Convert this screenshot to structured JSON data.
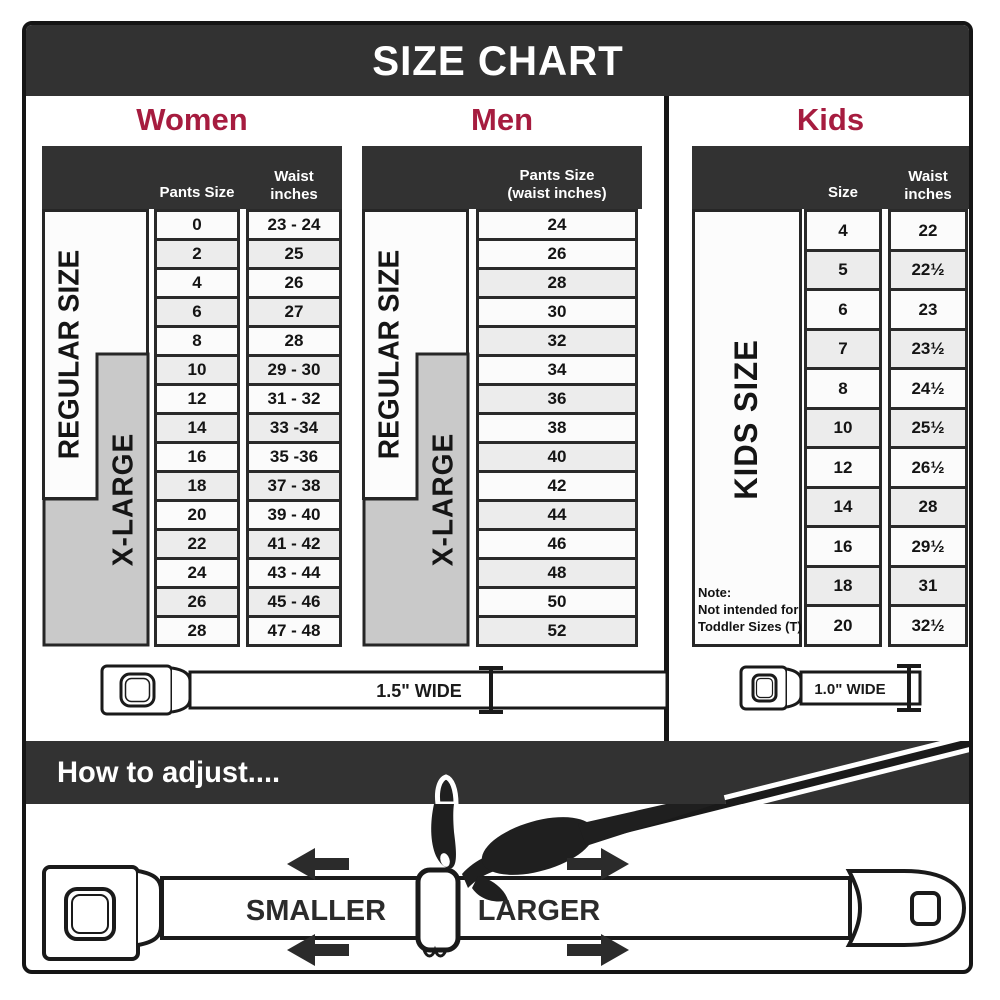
{
  "title": "SIZE CHART",
  "colors": {
    "accent_red": "#A61C3F",
    "header_bar": "#323232",
    "row_alt": "#ECECEC",
    "row_white": "#FBFBFB",
    "label_gray": "#C9C9C9",
    "table_border": "#2A2A2A"
  },
  "women": {
    "heading": "Women",
    "regular_label": "REGULAR SIZE",
    "xlarge_label": "X-LARGE",
    "col_pants": "Pants Size",
    "col_waist": "Waist\ninches",
    "rows": [
      [
        "0",
        "23 - 24"
      ],
      [
        "2",
        "25"
      ],
      [
        "4",
        "26"
      ],
      [
        "6",
        "27"
      ],
      [
        "8",
        "28"
      ],
      [
        "10",
        "29 - 30"
      ],
      [
        "12",
        "31 - 32"
      ],
      [
        "14",
        "33 -34"
      ],
      [
        "16",
        "35 -36"
      ],
      [
        "18",
        "37 - 38"
      ],
      [
        "20",
        "39 - 40"
      ],
      [
        "22",
        "41 - 42"
      ],
      [
        "24",
        "43 - 44"
      ],
      [
        "26",
        "45 - 46"
      ],
      [
        "28",
        "47 - 48"
      ]
    ]
  },
  "men": {
    "heading": "Men",
    "regular_label": "REGULAR SIZE",
    "xlarge_label": "X-LARGE",
    "col_pants": "Pants Size\n(waist inches)",
    "rows": [
      "24",
      "26",
      "28",
      "30",
      "32",
      "34",
      "36",
      "38",
      "40",
      "42",
      "44",
      "46",
      "48",
      "50",
      "52"
    ]
  },
  "kids": {
    "heading": "Kids",
    "size_label": "KIDS SIZE",
    "col_size": "Size",
    "col_waist": "Waist\ninches",
    "note": "Note:\nNot intended for\nToddler Sizes (T)",
    "rows": [
      [
        "4",
        "22"
      ],
      [
        "5",
        "22½"
      ],
      [
        "6",
        "23"
      ],
      [
        "7",
        "23½"
      ],
      [
        "8",
        "24½"
      ],
      [
        "10",
        "25½"
      ],
      [
        "12",
        "26½"
      ],
      [
        "14",
        "28"
      ],
      [
        "16",
        "29½"
      ],
      [
        "18",
        "31"
      ],
      [
        "20",
        "32½"
      ]
    ]
  },
  "belts": {
    "adult_width_label": "1.5\" WIDE",
    "kids_width_label": "1.0\" WIDE"
  },
  "adjust": {
    "heading": "How to adjust....",
    "smaller": "SMALLER",
    "larger": "LARGER"
  }
}
